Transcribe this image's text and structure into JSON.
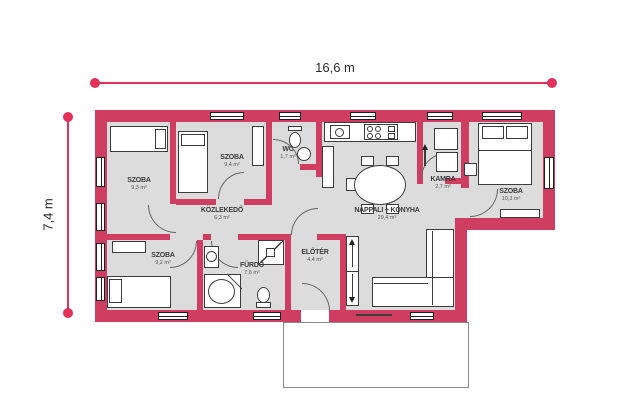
{
  "dimensions": {
    "width": "16,6 m",
    "height": "7,4 m"
  },
  "rooms": [
    {
      "name": "SZOBA",
      "area": "9,3 m²"
    },
    {
      "name": "SZOBA",
      "area": "9,4 m²"
    },
    {
      "name": "WC",
      "area": "1,7 m²"
    },
    {
      "name": "KÖZLEKEDŐ",
      "area": "6,3 m²"
    },
    {
      "name": "KAMRA",
      "area": "2,7 m²"
    },
    {
      "name": "NAPPALI + KONYHA",
      "area": "29,4 m²"
    },
    {
      "name": "SZOBA",
      "area": "10,3 m²"
    },
    {
      "name": "SZOBA",
      "area": "9,2 m²"
    },
    {
      "name": "FÜRDŐ",
      "area": "7,6 m²"
    },
    {
      "name": "ELŐTÉR",
      "area": "4,4 m²"
    }
  ],
  "colors": {
    "wall": "#cf3d61",
    "floor": "#dcdcdc",
    "dimension": "#e23059",
    "furniture_outline": "#3c3c3c"
  }
}
